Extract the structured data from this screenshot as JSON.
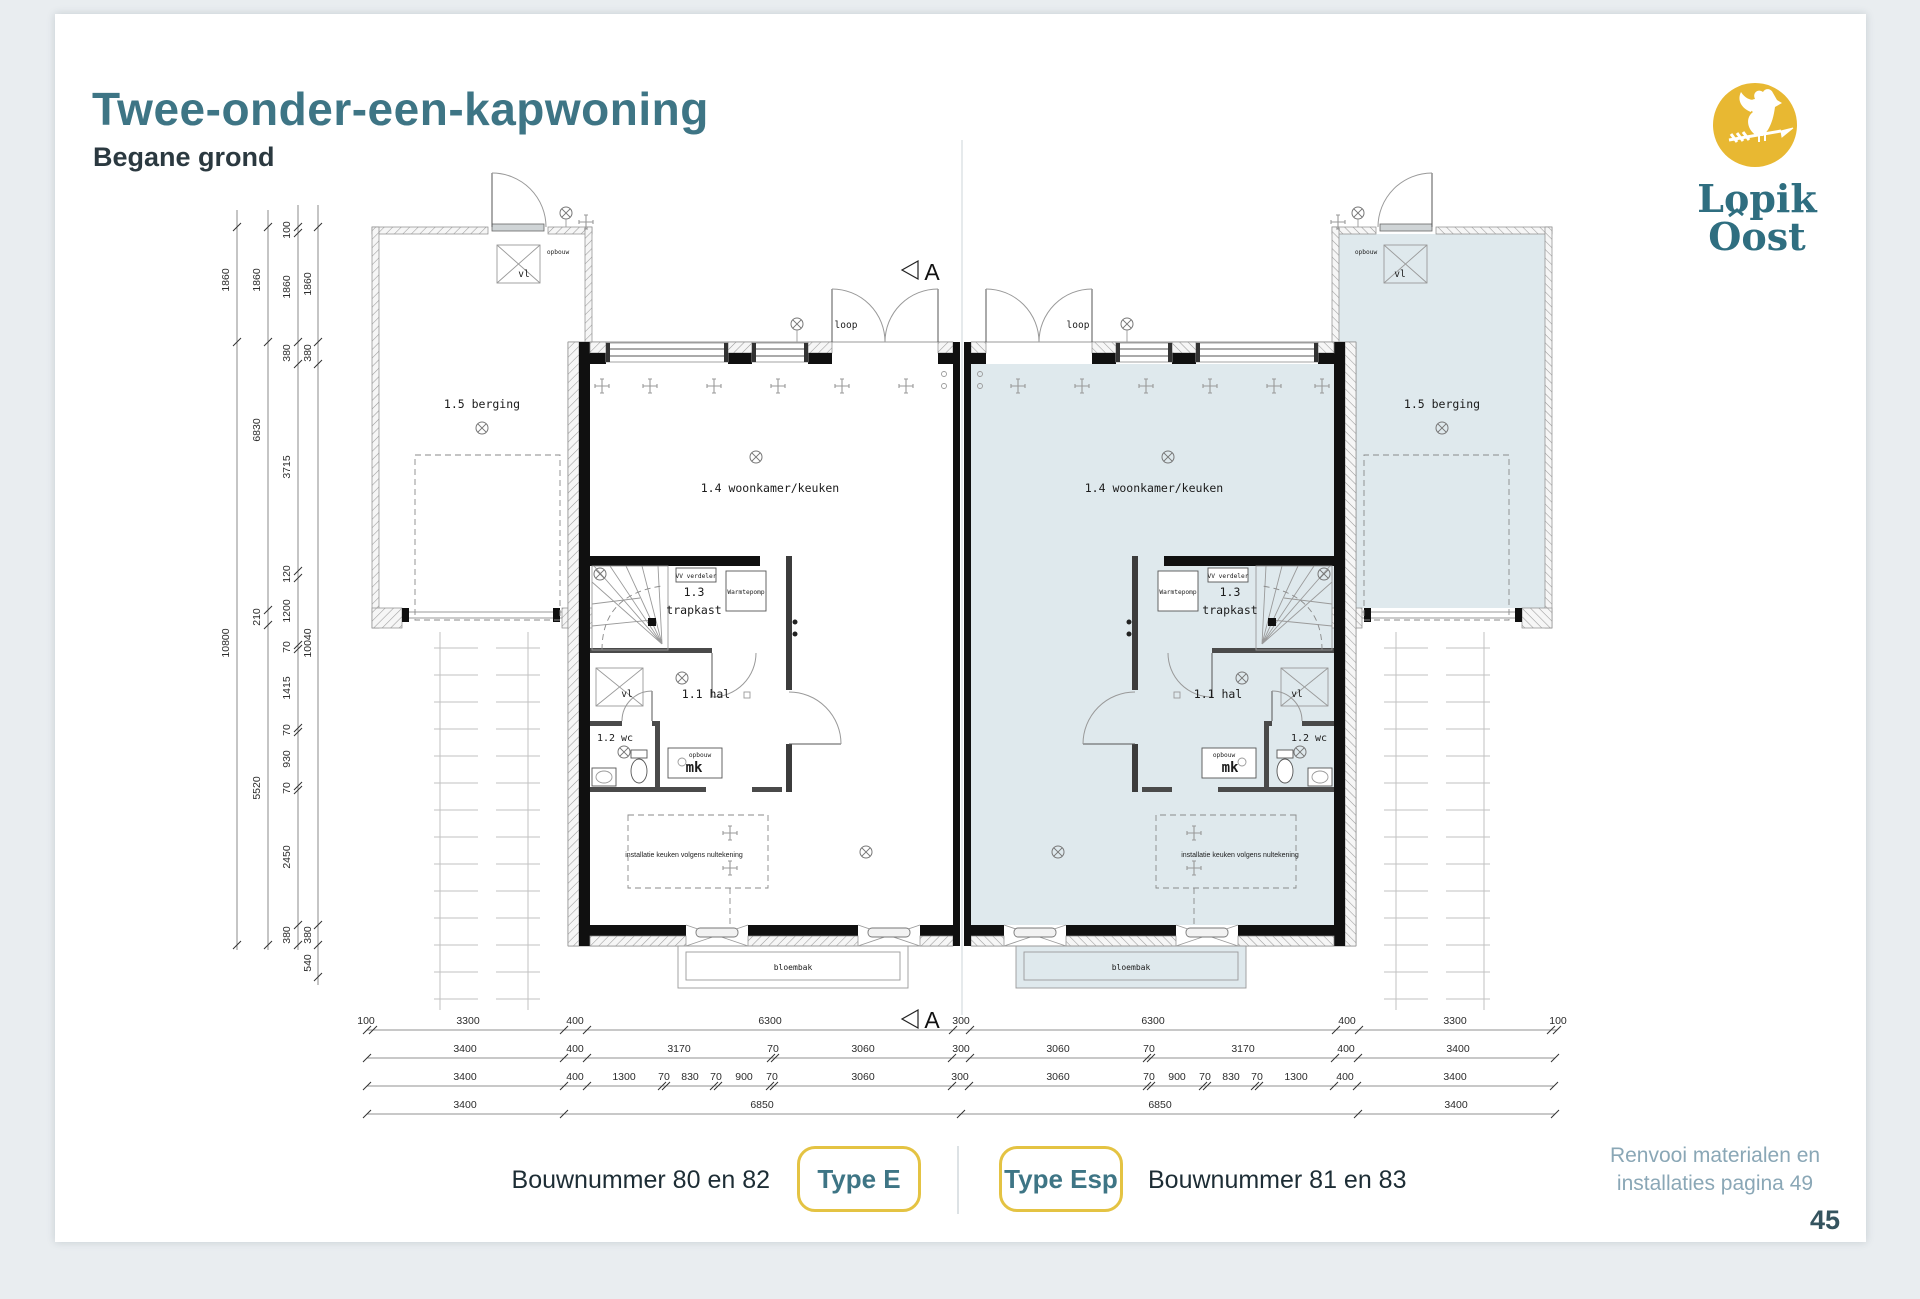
{
  "page": {
    "title": "Twee-onder-een-kapwoning",
    "subtitle": "Begane grond",
    "note1": "Renvooi materialen en",
    "note2": "installaties pagina 49",
    "page_number": "45"
  },
  "logo": {
    "line1": "Lopik",
    "line2": "Oost"
  },
  "footer": {
    "caption_left": "Bouwnummer 80 en 82",
    "badge_left": "Type E",
    "badge_right": "Type Esp",
    "caption_right": "Bouwnummer 81 en 83"
  },
  "colors": {
    "accent_teal": "#3e7585",
    "logo_yellow": "#e8b832",
    "badge_border": "#e4c343",
    "highlight_fill": "#dfe9ed",
    "note_color": "#8aa7b6"
  },
  "plan": {
    "labels": {
      "living": "1.4 woonkamer/keuken",
      "stair_no": "1.3",
      "stair": "trapkast",
      "hall": "1.1 hal",
      "wc": "1.2 wc",
      "mk": "mk",
      "opbouw": "opbouw",
      "storage": "1.5 berging",
      "planter": "bloembak",
      "walk": "loop",
      "vl": "vl",
      "vv": "VV verdeler",
      "heatpump": "Warmtepomp",
      "kitchen_note": "installatie keuken volgens nultekening",
      "section": "A"
    },
    "dims": {
      "left": {
        "col1": [
          "1860",
          "10800"
        ],
        "col2": [
          "1860",
          "6830",
          "210",
          "5520"
        ],
        "col3": [
          "100",
          "1860",
          "380",
          "3715",
          "120",
          "1200",
          "70",
          "1415",
          "70",
          "930",
          "70",
          "2450",
          "380"
        ],
        "col4": [
          "1860",
          "380",
          "10040",
          "380",
          "540"
        ]
      },
      "bottom": {
        "row1": [
          "100",
          "3300",
          "400",
          "6300",
          "300",
          "6300",
          "400",
          "3300",
          "100"
        ],
        "row2": [
          "3400",
          "400",
          "3170",
          "70",
          "3060",
          "300",
          "3060",
          "70",
          "3170",
          "400",
          "3400"
        ],
        "row3": [
          "3400",
          "400",
          "1300",
          "70",
          "830",
          "70",
          "900",
          "70",
          "3060",
          "300",
          "3060",
          "70",
          "900",
          "70",
          "830",
          "70",
          "1300",
          "400",
          "3400"
        ],
        "row4": [
          "3400",
          "6850",
          "6850",
          "3400"
        ]
      }
    }
  }
}
